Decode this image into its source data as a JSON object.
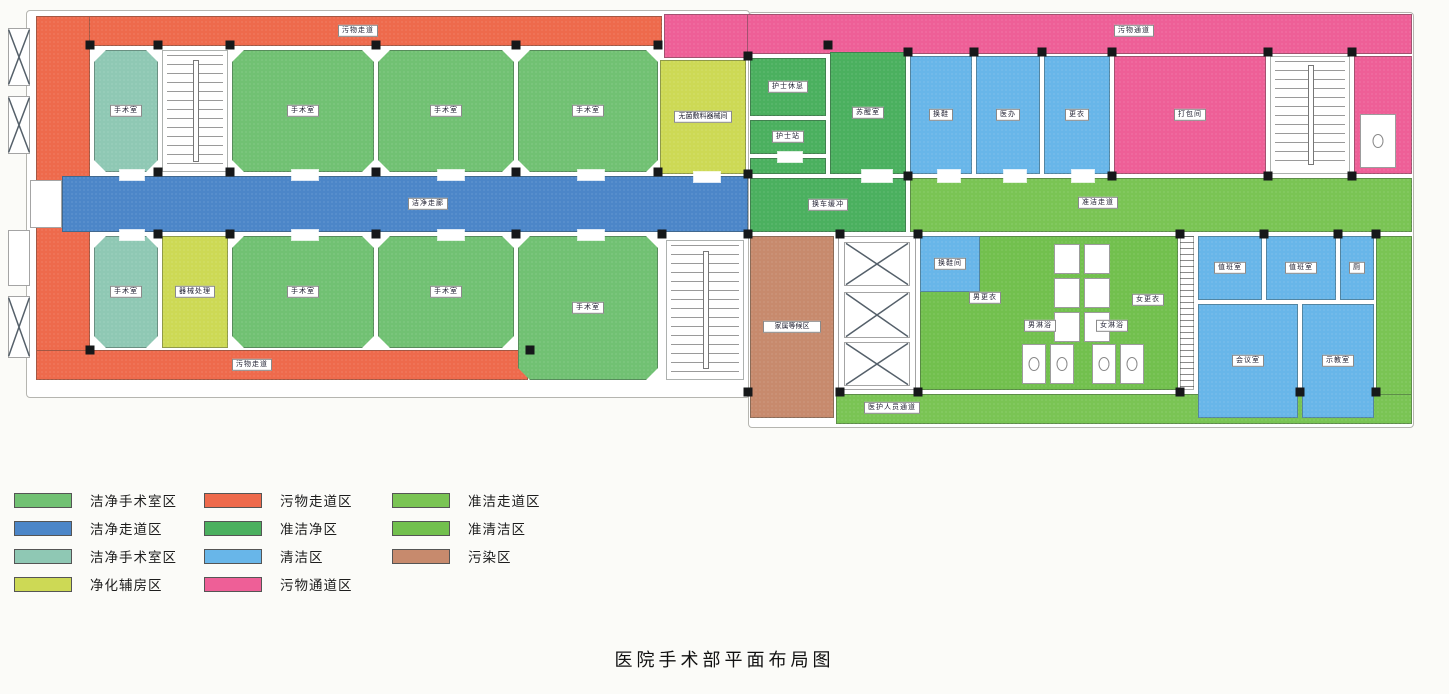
{
  "title": "医院手术部平面布局图",
  "colors": {
    "green": "#71c173",
    "blue": "#4c86c8",
    "teal": "#8fc8b4",
    "yellow": "#cdd955",
    "orange": "#ee6a4c",
    "dgreen": "#4bb05f",
    "lblue": "#68b6e9",
    "pink": "#ee5f97",
    "bgreen": "#7ac454",
    "bgreen2": "#72c04e",
    "brown": "#c78a6d"
  },
  "legend": {
    "columns": [
      {
        "items": [
          {
            "label": "洁净手术室区",
            "color": "green"
          },
          {
            "label": "洁净走道区",
            "color": "blue"
          },
          {
            "label": "洁净手术室区",
            "color": "teal"
          },
          {
            "label": "净化辅房区",
            "color": "yellow"
          }
        ]
      },
      {
        "items": [
          {
            "label": "污物走道区",
            "color": "orange"
          },
          {
            "label": "准洁净区",
            "color": "dgreen"
          },
          {
            "label": "清洁区",
            "color": "lblue"
          },
          {
            "label": "污物通道区",
            "color": "pink"
          }
        ]
      },
      {
        "items": [
          {
            "label": "准洁走道区",
            "color": "bgreen"
          },
          {
            "label": "准清洁区",
            "color": "bgreen2"
          },
          {
            "label": "污染区",
            "color": "brown"
          }
        ]
      }
    ]
  },
  "plan": {
    "wings": [
      {
        "x": 26,
        "y": 10,
        "w": 722,
        "h": 386
      },
      {
        "x": 748,
        "y": 12,
        "w": 664,
        "h": 414
      }
    ],
    "zones": [
      {
        "id": "waste-corridor-top",
        "type": "corridor",
        "color": "orange",
        "x": 36,
        "y": 16,
        "w": 626,
        "h": 30,
        "label": "污物走道",
        "lx": 358,
        "ly": 31
      },
      {
        "id": "waste-corridor-left",
        "type": "corridor",
        "color": "orange",
        "x": 36,
        "y": 16,
        "w": 54,
        "h": 362
      },
      {
        "id": "waste-corridor-bottom",
        "type": "corridor",
        "color": "orange",
        "x": 36,
        "y": 350,
        "w": 492,
        "h": 30,
        "label": "污物走道",
        "lx": 252,
        "ly": 365
      },
      {
        "id": "or-room-1",
        "type": "or",
        "color": "teal",
        "x": 94,
        "y": 50,
        "w": 64,
        "h": 122,
        "label": "手术室"
      },
      {
        "id": "stairwell-left",
        "type": "stair",
        "x": 162,
        "y": 50,
        "w": 66,
        "h": 122
      },
      {
        "id": "or-room-2",
        "type": "or",
        "color": "green",
        "x": 232,
        "y": 50,
        "w": 142,
        "h": 122,
        "label": "手术室"
      },
      {
        "id": "or-room-3",
        "type": "or",
        "color": "green",
        "x": 378,
        "y": 50,
        "w": 136,
        "h": 122,
        "label": "手术室"
      },
      {
        "id": "or-room-4",
        "type": "or",
        "color": "green",
        "x": 518,
        "y": 50,
        "w": 140,
        "h": 122,
        "label": "手术室"
      },
      {
        "id": "clean-corridor",
        "type": "corridor",
        "color": "blue",
        "x": 62,
        "y": 176,
        "w": 686,
        "h": 56,
        "label": "洁净走廊",
        "lx": 428,
        "ly": 204
      },
      {
        "id": "or-room-8",
        "type": "or",
        "color": "teal",
        "x": 94,
        "y": 236,
        "w": 64,
        "h": 112,
        "label": "手术室"
      },
      {
        "id": "instrument-processing-room",
        "type": "room",
        "color": "yellow",
        "x": 162,
        "y": 236,
        "w": 66,
        "h": 112,
        "label": "器械处理"
      },
      {
        "id": "or-room-7",
        "type": "or",
        "color": "green",
        "x": 232,
        "y": 236,
        "w": 142,
        "h": 112,
        "label": "手术室"
      },
      {
        "id": "or-room-6",
        "type": "or",
        "color": "green",
        "x": 378,
        "y": 236,
        "w": 136,
        "h": 112,
        "label": "手术室"
      },
      {
        "id": "or-room-5",
        "type": "or",
        "color": "green",
        "x": 518,
        "y": 236,
        "w": 140,
        "h": 144,
        "label": "手术室"
      },
      {
        "id": "stairwell-middle",
        "type": "stair",
        "x": 666,
        "y": 240,
        "w": 78,
        "h": 140
      },
      {
        "id": "waste-passage-top",
        "type": "corridor",
        "color": "pink",
        "x": 664,
        "y": 14,
        "w": 748,
        "h": 40,
        "label": "污物通道",
        "lx": 1134,
        "ly": 31
      },
      {
        "id": "waste-passage-block",
        "type": "corridor",
        "color": "pink",
        "x": 664,
        "y": 14,
        "w": 84,
        "h": 44
      },
      {
        "id": "sterile-supply-room",
        "type": "room",
        "color": "yellow",
        "x": 660,
        "y": 60,
        "w": 86,
        "h": 114,
        "label": "无菌敷料器械间",
        "wrap": true
      },
      {
        "id": "nurse-rest-room",
        "type": "room",
        "color": "dgreen",
        "x": 750,
        "y": 58,
        "w": 76,
        "h": 58,
        "label": "护士休息"
      },
      {
        "id": "nurse-station",
        "type": "room",
        "color": "dgreen",
        "x": 750,
        "y": 120,
        "w": 76,
        "h": 34,
        "label": "护士站"
      },
      {
        "id": "storage-niche",
        "type": "room",
        "color": "dgreen",
        "x": 750,
        "y": 158,
        "w": 76,
        "h": 16
      },
      {
        "id": "recovery-room",
        "type": "room",
        "color": "dgreen",
        "x": 830,
        "y": 52,
        "w": 76,
        "h": 122,
        "label": "苏醒室"
      },
      {
        "id": "shoe-change-room",
        "type": "room",
        "color": "lblue",
        "x": 910,
        "y": 56,
        "w": 62,
        "h": 118,
        "label": "换鞋"
      },
      {
        "id": "doctor-office",
        "type": "room",
        "color": "lblue",
        "x": 976,
        "y": 56,
        "w": 64,
        "h": 118,
        "label": "医办"
      },
      {
        "id": "changing-room-small",
        "type": "room",
        "color": "lblue",
        "x": 1044,
        "y": 56,
        "w": 66,
        "h": 118,
        "label": "更衣"
      },
      {
        "id": "packing-room",
        "type": "room",
        "color": "pink",
        "x": 1114,
        "y": 56,
        "w": 152,
        "h": 118,
        "label": "打包间"
      },
      {
        "id": "stairwell-right",
        "type": "stair",
        "x": 1270,
        "y": 56,
        "w": 80,
        "h": 118
      },
      {
        "id": "waste-room-end",
        "type": "room",
        "color": "pink",
        "x": 1354,
        "y": 56,
        "w": 58,
        "h": 118
      },
      {
        "id": "toilet-fixture-right",
        "type": "fixture",
        "x": 1360,
        "y": 114,
        "w": 36,
        "h": 54,
        "dot": true
      },
      {
        "id": "cart-exchange-buffer",
        "type": "room",
        "color": "dgreen",
        "x": 750,
        "y": 178,
        "w": 156,
        "h": 54,
        "label": "换车缓冲"
      },
      {
        "id": "semi-clean-corridor",
        "type": "corridor",
        "color": "bgreen",
        "x": 910,
        "y": 178,
        "w": 502,
        "h": 54,
        "label": "准洁走道",
        "lx": 1098,
        "ly": 203
      },
      {
        "id": "semi-clean-corridor-right",
        "type": "corridor",
        "color": "bgreen",
        "x": 1376,
        "y": 236,
        "w": 36,
        "h": 188
      },
      {
        "id": "staff-passage-bottom",
        "type": "corridor",
        "color": "bgreen",
        "x": 836,
        "y": 394,
        "w": 576,
        "h": 30,
        "label": "医护人员通道",
        "lx": 892,
        "ly": 408
      },
      {
        "id": "contaminated-waiting-area",
        "type": "room",
        "color": "brown",
        "x": 750,
        "y": 236,
        "w": 84,
        "h": 182,
        "label": "家属等候区",
        "wrap": true
      },
      {
        "id": "elevator-lobby",
        "type": "lobby",
        "x": 838,
        "y": 236,
        "w": 78,
        "h": 154
      },
      {
        "id": "elevator-1",
        "type": "elevator",
        "x": 844,
        "y": 242,
        "w": 66,
        "h": 44
      },
      {
        "id": "elevator-2",
        "type": "elevator",
        "x": 844,
        "y": 292,
        "w": 66,
        "h": 46
      },
      {
        "id": "elevator-3",
        "type": "elevator",
        "x": 844,
        "y": 342,
        "w": 66,
        "h": 44
      },
      {
        "id": "staff-changing-area",
        "type": "room",
        "color": "bgreen2",
        "x": 920,
        "y": 236,
        "w": 258,
        "h": 154
      },
      {
        "id": "shoe-change-room-2",
        "type": "room",
        "color": "lblue",
        "x": 920,
        "y": 236,
        "w": 60,
        "h": 56,
        "label": "换鞋间"
      },
      {
        "id": "mens-changing-label",
        "type": "label",
        "label": "男更衣",
        "lx": 985,
        "ly": 298
      },
      {
        "id": "womens-changing-label",
        "type": "label",
        "label": "女更衣",
        "lx": 1148,
        "ly": 300
      },
      {
        "id": "mens-shower-label",
        "type": "label",
        "label": "男淋浴",
        "lx": 1040,
        "ly": 326
      },
      {
        "id": "womens-shower-label",
        "type": "label",
        "label": "女淋浴",
        "lx": 1112,
        "ly": 326
      },
      {
        "id": "locker-1",
        "type": "fixture",
        "x": 1054,
        "y": 244,
        "w": 26,
        "h": 30
      },
      {
        "id": "locker-2",
        "type": "fixture",
        "x": 1084,
        "y": 244,
        "w": 26,
        "h": 30
      },
      {
        "id": "locker-3",
        "type": "fixture",
        "x": 1054,
        "y": 278,
        "w": 26,
        "h": 30
      },
      {
        "id": "locker-4",
        "type": "fixture",
        "x": 1084,
        "y": 278,
        "w": 26,
        "h": 30
      },
      {
        "id": "locker-5",
        "type": "fixture",
        "x": 1054,
        "y": 312,
        "w": 26,
        "h": 30
      },
      {
        "id": "locker-6",
        "type": "fixture",
        "x": 1084,
        "y": 312,
        "w": 26,
        "h": 30
      },
      {
        "id": "shower-stall-1",
        "type": "fixture",
        "x": 1022,
        "y": 344,
        "w": 24,
        "h": 40,
        "dot": true
      },
      {
        "id": "shower-stall-2",
        "type": "fixture",
        "x": 1050,
        "y": 344,
        "w": 24,
        "h": 40,
        "dot": true
      },
      {
        "id": "shower-stall-3",
        "type": "fixture",
        "x": 1092,
        "y": 344,
        "w": 24,
        "h": 40,
        "dot": true
      },
      {
        "id": "shower-stall-4",
        "type": "fixture",
        "x": 1120,
        "y": 344,
        "w": 24,
        "h": 40,
        "dot": true
      },
      {
        "id": "ramp-strip",
        "type": "hatch",
        "x": 1180,
        "y": 236,
        "w": 14,
        "h": 154
      },
      {
        "id": "duty-room-1",
        "type": "room",
        "color": "lblue",
        "x": 1198,
        "y": 236,
        "w": 64,
        "h": 64,
        "label": "值班室"
      },
      {
        "id": "duty-room-2",
        "type": "room",
        "color": "lblue",
        "x": 1266,
        "y": 236,
        "w": 70,
        "h": 64,
        "label": "值班室"
      },
      {
        "id": "toilet-small-room",
        "type": "room",
        "color": "lblue",
        "x": 1340,
        "y": 236,
        "w": 34,
        "h": 64,
        "label": "厕"
      },
      {
        "id": "meeting-room",
        "type": "room",
        "color": "lblue",
        "x": 1198,
        "y": 304,
        "w": 100,
        "h": 114,
        "label": "会议室"
      },
      {
        "id": "demo-room",
        "type": "room",
        "color": "lblue",
        "x": 1302,
        "y": 304,
        "w": 72,
        "h": 114,
        "label": "示教室"
      },
      {
        "id": "left-elevator-1",
        "type": "elevator",
        "x": 8,
        "y": 28,
        "w": 22,
        "h": 58
      },
      {
        "id": "left-elevator-2",
        "type": "elevator",
        "x": 8,
        "y": 96,
        "w": 22,
        "h": 58
      },
      {
        "id": "left-shaft-1",
        "type": "lobby",
        "x": 8,
        "y": 230,
        "w": 22,
        "h": 56
      },
      {
        "id": "left-shaft-2",
        "type": "elevator",
        "x": 8,
        "y": 296,
        "w": 22,
        "h": 62
      },
      {
        "id": "entrance-gap",
        "type": "lobby",
        "x": 30,
        "y": 180,
        "w": 32,
        "h": 48
      }
    ],
    "columns": [
      [
        90,
        45
      ],
      [
        158,
        45
      ],
      [
        230,
        45
      ],
      [
        376,
        45
      ],
      [
        516,
        45
      ],
      [
        658,
        45
      ],
      [
        158,
        172
      ],
      [
        230,
        172
      ],
      [
        376,
        172
      ],
      [
        516,
        172
      ],
      [
        658,
        172
      ],
      [
        158,
        234
      ],
      [
        230,
        234
      ],
      [
        376,
        234
      ],
      [
        516,
        234
      ],
      [
        662,
        234
      ],
      [
        90,
        350
      ],
      [
        530,
        350
      ],
      [
        748,
        56
      ],
      [
        748,
        174
      ],
      [
        828,
        45
      ],
      [
        908,
        52
      ],
      [
        974,
        52
      ],
      [
        1042,
        52
      ],
      [
        1112,
        52
      ],
      [
        1268,
        52
      ],
      [
        1352,
        52
      ],
      [
        908,
        176
      ],
      [
        1112,
        176
      ],
      [
        1268,
        176
      ],
      [
        1352,
        176
      ],
      [
        840,
        234
      ],
      [
        918,
        234
      ],
      [
        1180,
        234
      ],
      [
        1264,
        234
      ],
      [
        1338,
        234
      ],
      [
        1376,
        234
      ],
      [
        840,
        392
      ],
      [
        918,
        392
      ],
      [
        1180,
        392
      ],
      [
        1300,
        392
      ],
      [
        1376,
        392
      ],
      [
        748,
        234
      ],
      [
        748,
        392
      ]
    ],
    "doors": [
      [
        120,
        170,
        24,
        10
      ],
      [
        292,
        170,
        26,
        10
      ],
      [
        438,
        170,
        26,
        10
      ],
      [
        578,
        170,
        26,
        10
      ],
      [
        120,
        230,
        24,
        10
      ],
      [
        292,
        230,
        26,
        10
      ],
      [
        438,
        230,
        26,
        10
      ],
      [
        578,
        230,
        26,
        10
      ],
      [
        938,
        170,
        22,
        12
      ],
      [
        1004,
        170,
        22,
        12
      ],
      [
        1072,
        170,
        22,
        12
      ],
      [
        862,
        170,
        30,
        12
      ],
      [
        778,
        152,
        24,
        10
      ],
      [
        694,
        172,
        26,
        10
      ]
    ]
  }
}
